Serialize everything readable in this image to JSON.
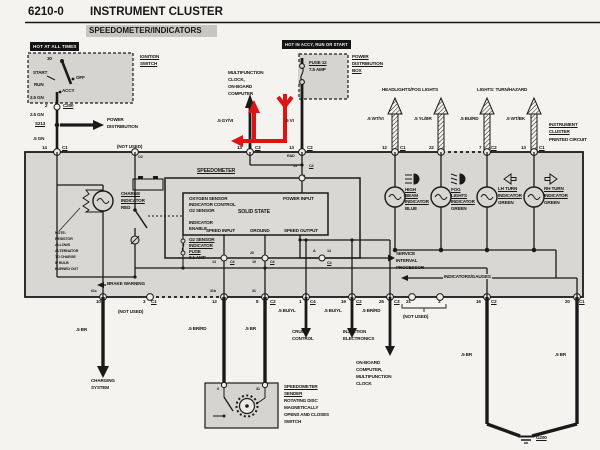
{
  "header": {
    "code": "6210-0",
    "title": "INSTRUMENT CLUSTER",
    "subtitle": "SPEEDOMETER/INDICATORS"
  },
  "banners": {
    "hot_at_all_times": "HOT AT ALL TIMES",
    "hot_in_accy": "HOT IN ACCY, RUN OR START"
  },
  "colors": {
    "paper": "#f4f3ef",
    "cluster_fill": "#d8d7d3",
    "component_fill": "#d5d4d0",
    "line": "#1a1a1a",
    "annotation_red": "#dd1414"
  },
  "annotation": {
    "type": "red-arrow-overlay",
    "description": "red path with left arrowhead at pin 13/C3 area, up arrow beside multifunction clock wire, down chevron on .5 VI fuse wire"
  },
  "labels": [
    {
      "t": "IGNITION",
      "x": 140,
      "y": 54,
      "c": "u"
    },
    {
      "t": "SWITCH",
      "x": 140,
      "y": 61,
      "c": "u"
    },
    {
      "t": "30",
      "x": 47,
      "y": 56
    },
    {
      "t": "START",
      "x": 33,
      "y": 70
    },
    {
      "t": "RUN",
      "x": 34,
      "y": 82
    },
    {
      "t": "OFF",
      "x": 76,
      "y": 75
    },
    {
      "t": "ACCY",
      "x": 62,
      "y": 88
    },
    {
      "t": "2.5 GN",
      "x": 30,
      "y": 95
    },
    {
      "t": "2",
      "x": 45,
      "y": 103
    },
    {
      "t": "C200",
      "x": 63,
      "y": 103,
      "c": "u"
    },
    {
      "t": "2.5 GN",
      "x": 30,
      "y": 112
    },
    {
      "t": "S213",
      "x": 35,
      "y": 121,
      "c": "u"
    },
    {
      "t": "POWER",
      "x": 107,
      "y": 117
    },
    {
      "t": "DISTRIBUTION",
      "x": 107,
      "y": 124
    },
    {
      "t": ".5 GN",
      "x": 33,
      "y": 136
    },
    {
      "t": "14",
      "x": 42,
      "y": 145
    },
    {
      "t": "C1",
      "x": 62,
      "y": 145,
      "c": "u"
    },
    {
      "t": "(NOT USED)",
      "x": 117,
      "y": 144
    },
    {
      "t": "O2",
      "x": 138,
      "y": 155,
      "c": "s3"
    },
    {
      "t": "MULTIFUNCTION",
      "x": 228,
      "y": 70
    },
    {
      "t": "CLOCK,",
      "x": 228,
      "y": 77
    },
    {
      "t": "ON-BOARD",
      "x": 228,
      "y": 84
    },
    {
      "t": "COMPUTER",
      "x": 228,
      "y": 91
    },
    {
      "t": ".5 GY/VI",
      "x": 217,
      "y": 118
    },
    {
      "t": "13",
      "x": 237,
      "y": 145
    },
    {
      "t": "C3",
      "x": 255,
      "y": 145,
      "c": "u"
    },
    {
      "t": "FUSE 12",
      "x": 309,
      "y": 60,
      "c": "u"
    },
    {
      "t": "7.5 AMP",
      "x": 309,
      "y": 67
    },
    {
      "t": "POWER",
      "x": 352,
      "y": 54,
      "c": "u"
    },
    {
      "t": "DISTRIBUTION",
      "x": 352,
      "y": 61,
      "c": "u"
    },
    {
      "t": "BOX",
      "x": 352,
      "y": 68,
      "c": "u"
    },
    {
      "t": ".5 VI",
      "x": 285,
      "y": 118
    },
    {
      "t": "13",
      "x": 289,
      "y": 145
    },
    {
      "t": "C2",
      "x": 307,
      "y": 145,
      "c": "u"
    },
    {
      "t": "RAD",
      "x": 287,
      "y": 154,
      "c": "s3"
    },
    {
      "t": "HEADLIGHTS/FOG LIGHTS",
      "x": 382,
      "y": 87
    },
    {
      "t": "LIGHTS: TURN/HAZARD",
      "x": 477,
      "y": 87
    },
    {
      "t": ".5 WT/VI",
      "x": 367,
      "y": 116
    },
    {
      "t": ".5 YL/BR",
      "x": 414,
      "y": 116
    },
    {
      "t": ".5 BU/RD",
      "x": 460,
      "y": 116
    },
    {
      "t": ".5 WT/BK",
      "x": 506,
      "y": 116
    },
    {
      "t": "12",
      "x": 382,
      "y": 145
    },
    {
      "t": "C1",
      "x": 400,
      "y": 145,
      "c": "u"
    },
    {
      "t": "22",
      "x": 429,
      "y": 145
    },
    {
      "t": "7",
      "x": 479,
      "y": 145
    },
    {
      "t": "C2",
      "x": 491,
      "y": 145,
      "c": "u"
    },
    {
      "t": "13",
      "x": 521,
      "y": 145
    },
    {
      "t": "C1",
      "x": 539,
      "y": 145,
      "c": "u"
    },
    {
      "t": "INSTRUMENT",
      "x": 549,
      "y": 122,
      "c": "u"
    },
    {
      "t": "CLUSTER",
      "x": 549,
      "y": 129,
      "c": "u"
    },
    {
      "t": "PRINTED CIRCUIT",
      "x": 549,
      "y": 137
    },
    {
      "t": "CHARGE",
      "x": 121,
      "y": 191,
      "c": "u"
    },
    {
      "t": "INDICATOR",
      "x": 121,
      "y": 198,
      "c": "u"
    },
    {
      "t": "RED",
      "x": 121,
      "y": 205
    },
    {
      "t": "NOTE:",
      "x": 55,
      "y": 231,
      "c": "s3"
    },
    {
      "t": "RESISTOR",
      "x": 55,
      "y": 237,
      "c": "s3"
    },
    {
      "t": "ALLOWS",
      "x": 55,
      "y": 243,
      "c": "s3"
    },
    {
      "t": "ALTERNATOR",
      "x": 55,
      "y": 249,
      "c": "s3"
    },
    {
      "t": "TO CHARGE",
      "x": 55,
      "y": 255,
      "c": "s3"
    },
    {
      "t": "IF BULB",
      "x": 55,
      "y": 261,
      "c": "s3"
    },
    {
      "t": "BURNED OUT",
      "x": 55,
      "y": 267,
      "c": "s3"
    },
    {
      "t": "BRAKE WARNING",
      "x": 106,
      "y": 281,
      "c": "bg"
    },
    {
      "t": "SPEEDOMETER",
      "x": 197,
      "y": 169,
      "c": "u s5"
    },
    {
      "t": "OXYGEN SENSOR",
      "x": 189,
      "y": 196
    },
    {
      "t": "INDICATOR CONTROL",
      "x": 189,
      "y": 202
    },
    {
      "t": "O2 SENSOR",
      "x": 189,
      "y": 208
    },
    {
      "t": "INDICATOR",
      "x": 189,
      "y": 220
    },
    {
      "t": "ENABLE",
      "x": 189,
      "y": 226
    },
    {
      "t": "SOLID STATE",
      "x": 238,
      "y": 210,
      "c": "s5"
    },
    {
      "t": "POWER INPUT",
      "x": 283,
      "y": 196
    },
    {
      "t": "SPEED INPUT",
      "x": 206,
      "y": 228
    },
    {
      "t": "GROUND",
      "x": 250,
      "y": 228
    },
    {
      "t": "SPEED OUTPUT",
      "x": 284,
      "y": 228
    },
    {
      "t": "O2 SENSOR",
      "x": 189,
      "y": 237,
      "c": "u"
    },
    {
      "t": "INDICATOR",
      "x": 189,
      "y": 243,
      "c": "u"
    },
    {
      "t": "FUSE",
      "x": 189,
      "y": 249,
      "c": "u"
    },
    {
      "t": "0.1 AMP",
      "x": 189,
      "y": 255
    },
    {
      "t": "14",
      "x": 293,
      "y": 164,
      "c": "s3"
    },
    {
      "t": "C4",
      "x": 309,
      "y": 164,
      "c": "u s3"
    },
    {
      "t": "9",
      "x": 303,
      "y": 174,
      "c": "s3"
    },
    {
      "t": "14",
      "x": 212,
      "y": 260,
      "c": "s3"
    },
    {
      "t": "C4",
      "x": 230,
      "y": 260,
      "c": "u s3"
    },
    {
      "t": "20",
      "x": 250,
      "y": 251,
      "c": "s3"
    },
    {
      "t": "19",
      "x": 252,
      "y": 260,
      "c": "s3"
    },
    {
      "t": "C4",
      "x": 270,
      "y": 260,
      "c": "u s3"
    },
    {
      "t": "A",
      "x": 313,
      "y": 249,
      "c": "s3"
    },
    {
      "t": "14",
      "x": 327,
      "y": 249,
      "c": "s3"
    },
    {
      "t": "C4",
      "x": 327,
      "y": 261,
      "c": "u s3"
    },
    {
      "t": "HIGH",
      "x": 405,
      "y": 187,
      "c": "u"
    },
    {
      "t": "BEAM",
      "x": 405,
      "y": 193,
      "c": "u"
    },
    {
      "t": "INDICATOR",
      "x": 405,
      "y": 199,
      "c": "u"
    },
    {
      "t": "BLUE",
      "x": 405,
      "y": 206
    },
    {
      "t": "FOG",
      "x": 451,
      "y": 187,
      "c": "u"
    },
    {
      "t": "LIGHTS",
      "x": 451,
      "y": 193,
      "c": "u"
    },
    {
      "t": "INDICATOR",
      "x": 451,
      "y": 199,
      "c": "u"
    },
    {
      "t": "GREEN",
      "x": 451,
      "y": 206
    },
    {
      "t": "LH TURN",
      "x": 498,
      "y": 186,
      "c": "u"
    },
    {
      "t": "INDICATOR",
      "x": 498,
      "y": 193,
      "c": "u"
    },
    {
      "t": "GREEN",
      "x": 498,
      "y": 200
    },
    {
      "t": "RH TURN",
      "x": 544,
      "y": 186,
      "c": "u"
    },
    {
      "t": "INDICATOR",
      "x": 544,
      "y": 193,
      "c": "u"
    },
    {
      "t": "GREEN",
      "x": 544,
      "y": 200
    },
    {
      "t": "SERVICE",
      "x": 396,
      "y": 251
    },
    {
      "t": "INTERVAL",
      "x": 396,
      "y": 258
    },
    {
      "t": "PROCESSOR",
      "x": 396,
      "y": 265
    },
    {
      "t": "INDICATORS/GAUGES",
      "x": 443,
      "y": 274,
      "c": "bg"
    },
    {
      "t": "61c",
      "x": 91,
      "y": 289,
      "c": "s3"
    },
    {
      "t": "10",
      "x": 96,
      "y": 299
    },
    {
      "t": "3",
      "x": 143,
      "y": 299
    },
    {
      "t": "C1",
      "x": 151,
      "y": 299,
      "c": "u"
    },
    {
      "t": "(NOT USED)",
      "x": 118,
      "y": 309
    },
    {
      "t": "31b",
      "x": 210,
      "y": 289,
      "c": "s3"
    },
    {
      "t": "12",
      "x": 212,
      "y": 299
    },
    {
      "t": "31",
      "x": 252,
      "y": 289,
      "c": "s3"
    },
    {
      "t": "8",
      "x": 256,
      "y": 299
    },
    {
      "t": "C2",
      "x": 270,
      "y": 299,
      "c": "u"
    },
    {
      "t": "1",
      "x": 299,
      "y": 299
    },
    {
      "t": "C4",
      "x": 310,
      "y": 299,
      "c": "u"
    },
    {
      "t": "19",
      "x": 341,
      "y": 299
    },
    {
      "t": "C2",
      "x": 356,
      "y": 299,
      "c": "u"
    },
    {
      "t": "26",
      "x": 379,
      "y": 299
    },
    {
      "t": "C3",
      "x": 394,
      "y": 299,
      "c": "u"
    },
    {
      "t": "21",
      "x": 406,
      "y": 299
    },
    {
      "t": "3",
      "x": 438,
      "y": 299
    },
    {
      "t": "(NOT USED)",
      "x": 403,
      "y": 314
    },
    {
      "t": "16",
      "x": 476,
      "y": 299
    },
    {
      "t": "C2",
      "x": 491,
      "y": 299,
      "c": "u"
    },
    {
      "t": "20",
      "x": 565,
      "y": 299
    },
    {
      "t": "C1",
      "x": 579,
      "y": 299,
      "c": "u"
    },
    {
      "t": ".5 BR",
      "x": 76,
      "y": 327
    },
    {
      "t": "CHARGING",
      "x": 91,
      "y": 378
    },
    {
      "t": "SYSTEM",
      "x": 91,
      "y": 385
    },
    {
      "t": ".5 BR/RD",
      "x": 188,
      "y": 326
    },
    {
      "t": ".5 BR",
      "x": 245,
      "y": 326
    },
    {
      "t": ".5 BU/YL",
      "x": 278,
      "y": 308
    },
    {
      "t": "CRUISE",
      "x": 292,
      "y": 329
    },
    {
      "t": "CONTROL",
      "x": 292,
      "y": 336
    },
    {
      "t": ".5 BU/YL",
      "x": 324,
      "y": 308
    },
    {
      "t": "INJECTION",
      "x": 343,
      "y": 329
    },
    {
      "t": "ELECTRONICS",
      "x": 343,
      "y": 336
    },
    {
      "t": ".5 BR/RD",
      "x": 362,
      "y": 308
    },
    {
      "t": "ON-BOARD",
      "x": 356,
      "y": 360
    },
    {
      "t": "COMPUTER,",
      "x": 356,
      "y": 367
    },
    {
      "t": "MULTIFUNCTION",
      "x": 356,
      "y": 374
    },
    {
      "t": "CLOCK",
      "x": 356,
      "y": 381
    },
    {
      "t": ".5 BR",
      "x": 461,
      "y": 352
    },
    {
      "t": ".5 BR",
      "x": 555,
      "y": 352
    },
    {
      "t": "G200",
      "x": 536,
      "y": 435,
      "c": "u"
    },
    {
      "t": "6",
      "x": 217,
      "y": 387,
      "c": "s3"
    },
    {
      "t": "31",
      "x": 256,
      "y": 387,
      "c": "s3"
    },
    {
      "t": "SPEEDOMETER",
      "x": 284,
      "y": 384,
      "c": "u"
    },
    {
      "t": "SENDER",
      "x": 284,
      "y": 391,
      "c": "u"
    },
    {
      "t": "ROTATING DISC",
      "x": 284,
      "y": 398
    },
    {
      "t": "MAGNETICALLY",
      "x": 284,
      "y": 405
    },
    {
      "t": "OPENS AND CLOSES",
      "x": 284,
      "y": 412
    },
    {
      "t": "SWITCH",
      "x": 284,
      "y": 419
    }
  ]
}
